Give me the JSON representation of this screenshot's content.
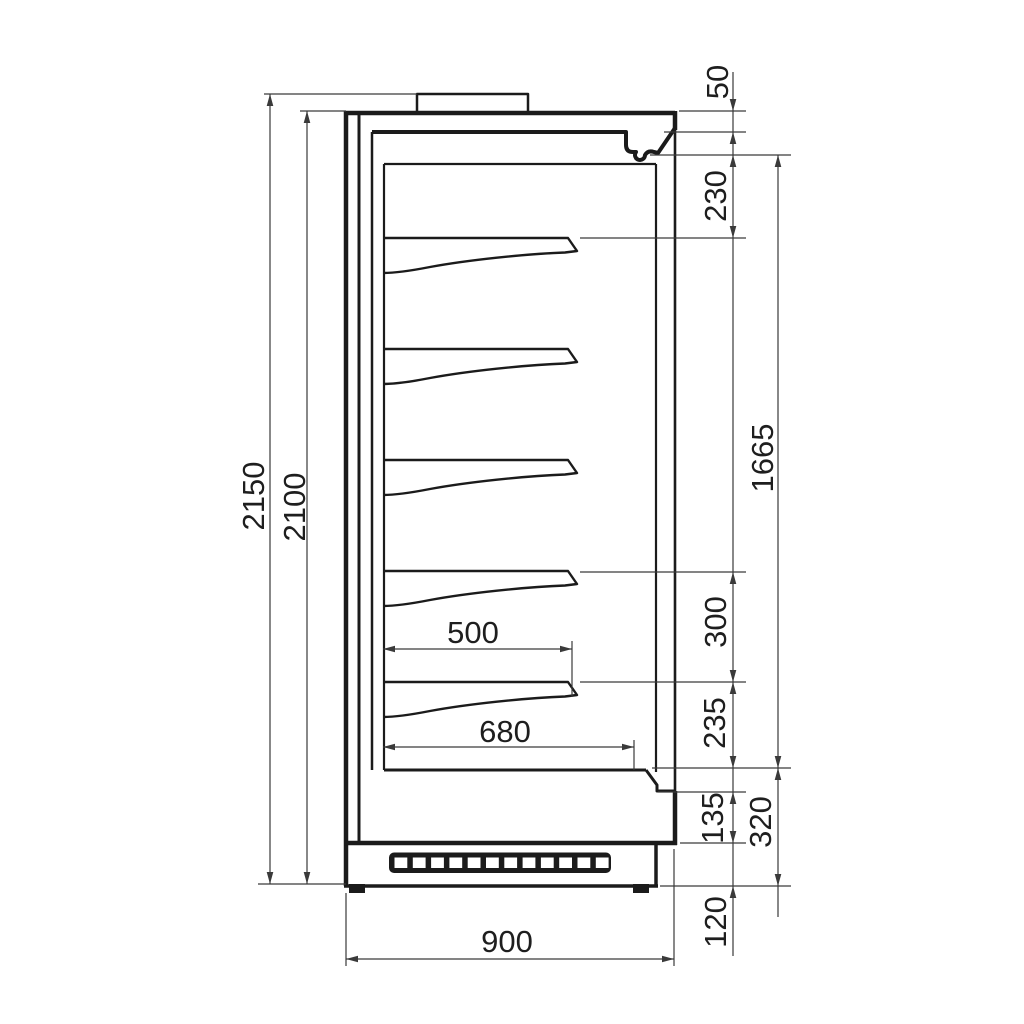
{
  "drawing": {
    "kind": "technical-dimension-drawing",
    "view": "side-section-multideck-display-cabinet",
    "labels": {
      "d2150": "2150",
      "d2100": "2100",
      "d50": "50",
      "d230": "230",
      "d1665": "1665",
      "d300": "300",
      "d235": "235",
      "d135": "135",
      "d320": "320",
      "d120": "120",
      "d500": "500",
      "d680": "680",
      "d900": "900"
    }
  }
}
